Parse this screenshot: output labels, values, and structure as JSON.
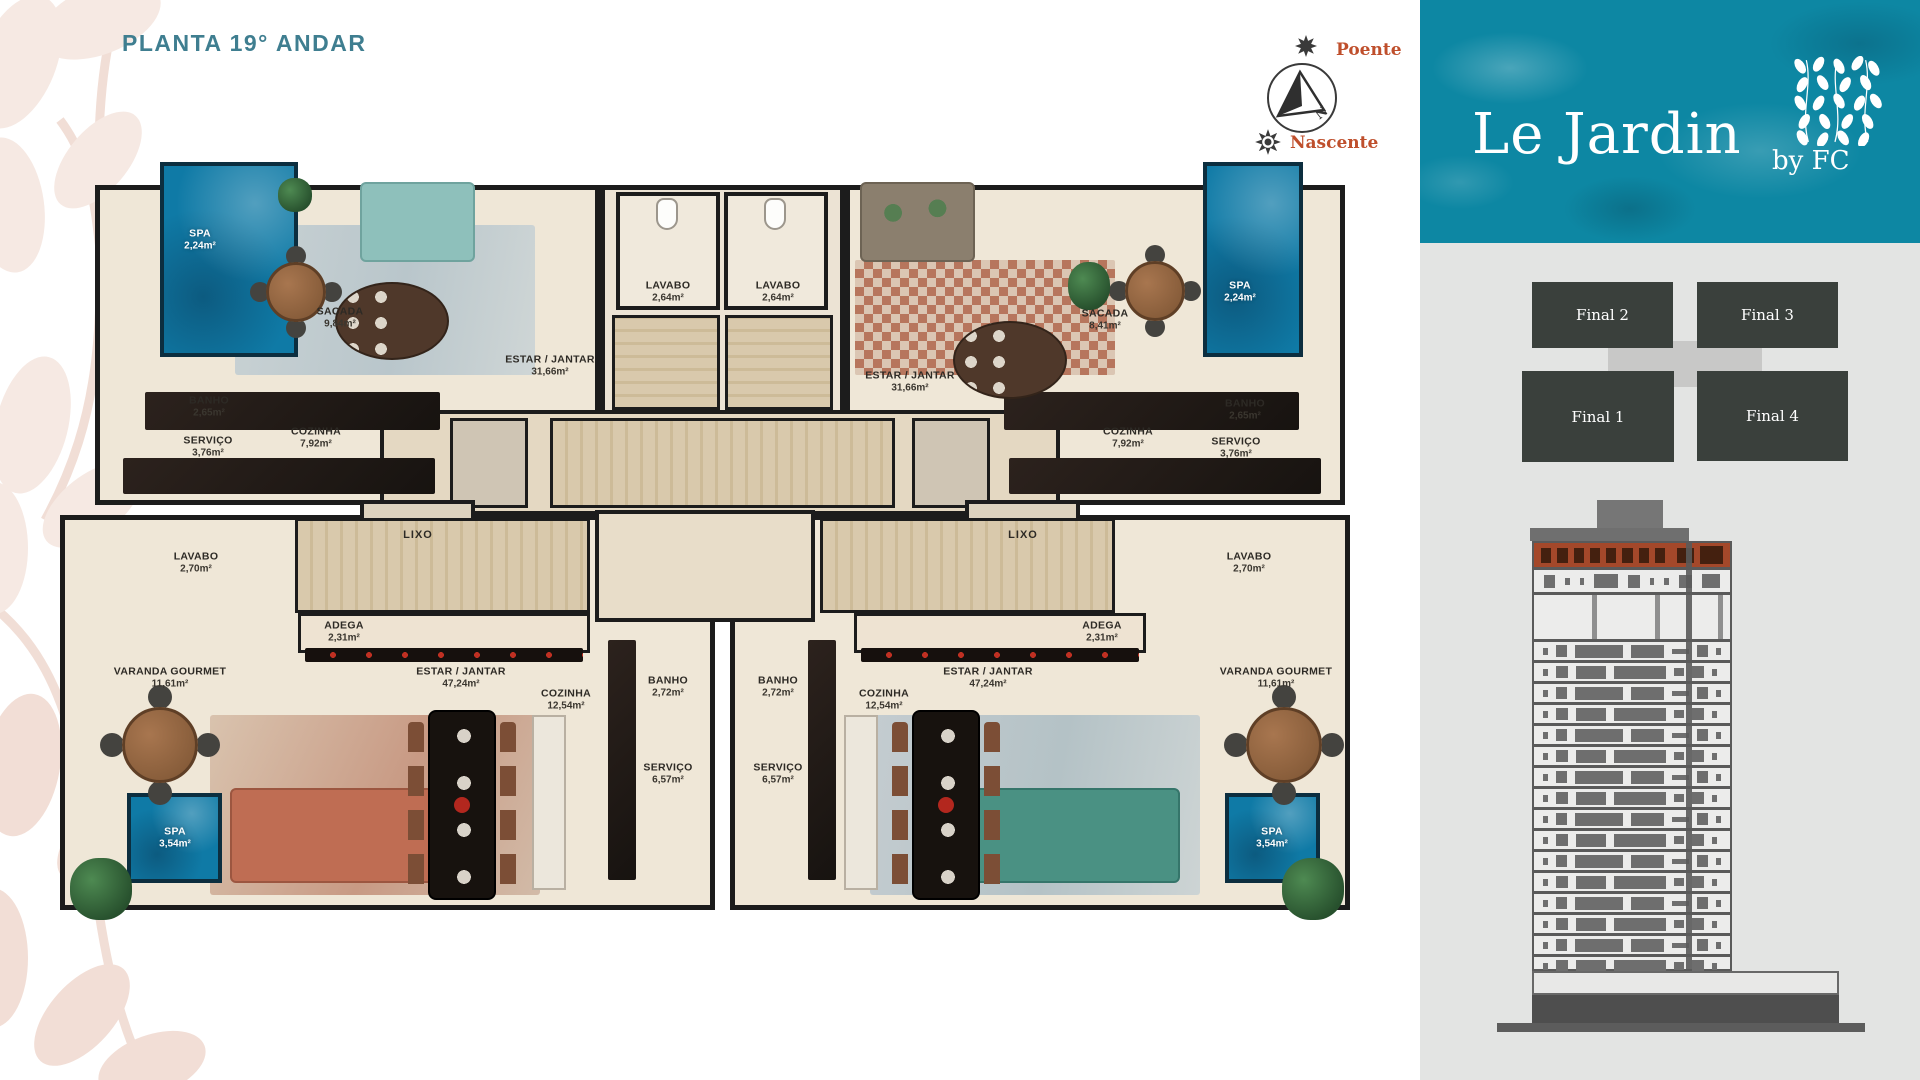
{
  "page": {
    "title": "PLANTA 19° ANDAR"
  },
  "compass": {
    "west_label": "Poente",
    "east_label": "Nascente",
    "north_label": "N"
  },
  "brand": {
    "name": "Le Jardin",
    "byline": "by FC"
  },
  "keyplan": {
    "units": [
      {
        "label": "Final 2"
      },
      {
        "label": "Final 3"
      },
      {
        "label": "Final 1"
      },
      {
        "label": "Final 4"
      }
    ]
  },
  "building": {
    "floor_rows": 16
  },
  "floorplan": {
    "unit_top_left": {
      "rooms": [
        {
          "name": "SPA",
          "area": "2,24m²"
        },
        {
          "name": "SACADA",
          "area": "9,84m²"
        },
        {
          "name": "ESTAR / JANTAR",
          "area": "31,66m²"
        },
        {
          "name": "LAVABO",
          "area": "2,64m²"
        },
        {
          "name": "BANHO",
          "area": "2,65m²"
        },
        {
          "name": "SERVIÇO",
          "area": "3,76m²"
        },
        {
          "name": "COZINHA",
          "area": "7,92m²"
        }
      ]
    },
    "unit_top_right": {
      "rooms": [
        {
          "name": "LAVABO",
          "area": "2,64m²"
        },
        {
          "name": "ESTAR / JANTAR",
          "area": "31,66m²"
        },
        {
          "name": "SACADA",
          "area": "8,41m²"
        },
        {
          "name": "SPA",
          "area": "2,24m²"
        },
        {
          "name": "COZINHA",
          "area": "7,92m²"
        },
        {
          "name": "BANHO",
          "area": "2,65m²"
        },
        {
          "name": "SERVIÇO",
          "area": "3,76m²"
        }
      ]
    },
    "core": {
      "rooms": [
        {
          "name": "LIXO"
        },
        {
          "name": "LIXO"
        }
      ]
    },
    "unit_bottom_left": {
      "rooms": [
        {
          "name": "LAVABO",
          "area": "2,70m²"
        },
        {
          "name": "ADEGA",
          "area": "2,31m²"
        },
        {
          "name": "VARANDA GOURMET",
          "area": "11,61m²"
        },
        {
          "name": "ESTAR / JANTAR",
          "area": "47,24m²"
        },
        {
          "name": "COZINHA",
          "area": "12,54m²"
        },
        {
          "name": "BANHO",
          "area": "2,72m²"
        },
        {
          "name": "SERVIÇO",
          "area": "6,57m²"
        },
        {
          "name": "SPA",
          "area": "3,54m²"
        }
      ]
    },
    "unit_bottom_right": {
      "rooms": [
        {
          "name": "BANHO",
          "area": "2,72m²"
        },
        {
          "name": "SERVIÇO",
          "area": "6,57m²"
        },
        {
          "name": "COZINHA",
          "area": "12,54m²"
        },
        {
          "name": "ESTAR / JANTAR",
          "area": "47,24m²"
        },
        {
          "name": "ADEGA",
          "area": "2,31m²"
        },
        {
          "name": "LAVABO",
          "area": "2,70m²"
        },
        {
          "name": "VARANDA GOURMET",
          "area": "11,61m²"
        },
        {
          "name": "SPA",
          "area": "3,54m²"
        }
      ]
    }
  },
  "colors": {
    "title_teal": "#3f7e90",
    "compass_orange": "#bf4f2c",
    "header_teal": "#0d87a3",
    "pool_blue": "#0f7aa6",
    "wall_dark": "#1c1c1c",
    "floor_cream": "#efe7d7",
    "sidebar_gray": "#e3e4e3",
    "keyplan_unit": "#3a403c",
    "elevation_highlight": "#a4482a"
  }
}
